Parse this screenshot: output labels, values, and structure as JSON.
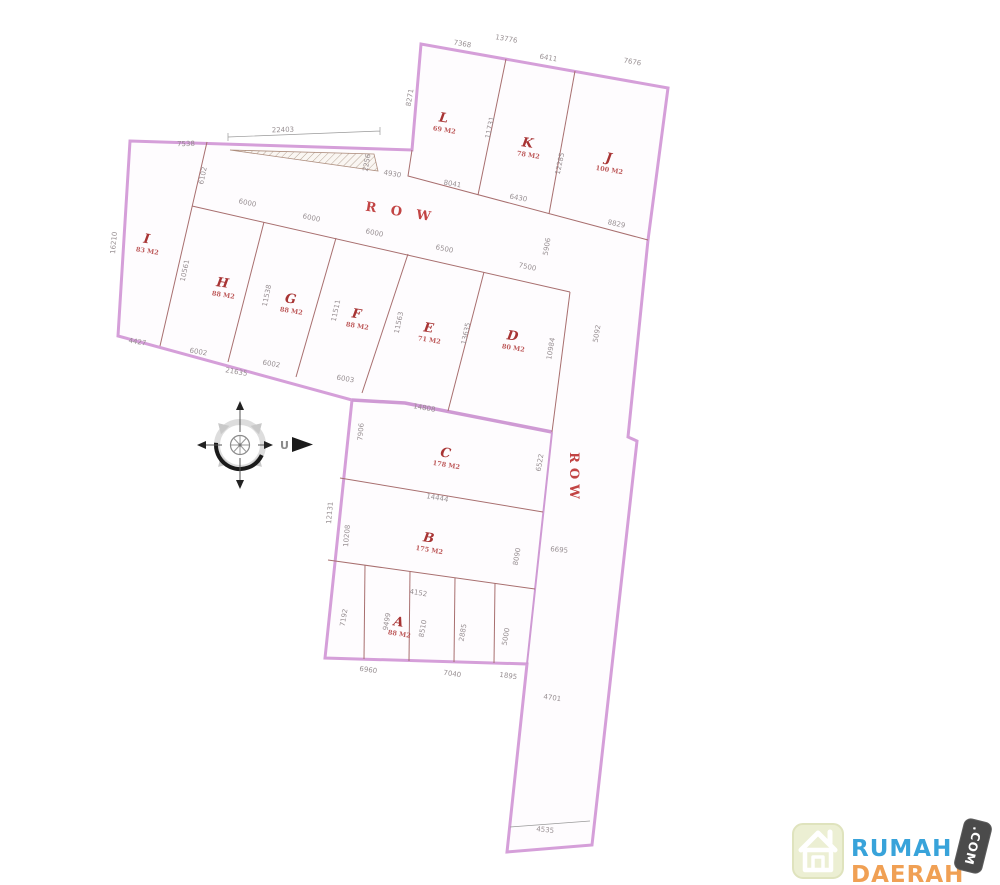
{
  "site_plan": {
    "road_label_diagonal": "R O W",
    "road_label_vertical": "ROW",
    "compass": {
      "north_label": "U"
    },
    "plots": [
      {
        "id": "L",
        "area": "69 M2",
        "x": 443,
        "y": 122,
        "r": 9
      },
      {
        "id": "K",
        "area": "78 M2",
        "x": 527,
        "y": 147,
        "r": 9
      },
      {
        "id": "J",
        "area": "100 M2",
        "x": 608,
        "y": 162,
        "r": 9
      },
      {
        "id": "I",
        "area": "83 M2",
        "x": 146,
        "y": 243,
        "r": 9
      },
      {
        "id": "H",
        "area": "88 M2",
        "x": 222,
        "y": 287,
        "r": 9
      },
      {
        "id": "G",
        "area": "88 M2",
        "x": 290,
        "y": 303,
        "r": 9
      },
      {
        "id": "F",
        "area": "88 M2",
        "x": 356,
        "y": 318,
        "r": 9
      },
      {
        "id": "E",
        "area": "71 M2",
        "x": 428,
        "y": 332,
        "r": 9
      },
      {
        "id": "D",
        "area": "80 M2",
        "x": 512,
        "y": 340,
        "r": 9
      },
      {
        "id": "C",
        "area": "178 M2",
        "x": 445,
        "y": 457,
        "r": 9
      },
      {
        "id": "B",
        "area": "175 M2",
        "x": 428,
        "y": 542,
        "r": 9
      },
      {
        "id": "A",
        "area": "88 M2",
        "x": 398,
        "y": 626,
        "r": 9
      }
    ],
    "dimensions": [
      {
        "v": "7368",
        "x": 462,
        "y": 46,
        "r": 10
      },
      {
        "v": "13776",
        "x": 506,
        "y": 41,
        "r": 10
      },
      {
        "v": "6411",
        "x": 548,
        "y": 60,
        "r": 10
      },
      {
        "v": "7676",
        "x": 632,
        "y": 64,
        "r": 10
      },
      {
        "v": "8271",
        "x": 412,
        "y": 98,
        "r": -80
      },
      {
        "v": "11731",
        "x": 492,
        "y": 128,
        "r": -78
      },
      {
        "v": "12285",
        "x": 562,
        "y": 164,
        "r": -78
      },
      {
        "v": "8041",
        "x": 452,
        "y": 186,
        "r": 10
      },
      {
        "v": "6430",
        "x": 518,
        "y": 200,
        "r": 10
      },
      {
        "v": "8829",
        "x": 616,
        "y": 226,
        "r": 12
      },
      {
        "v": "22403",
        "x": 283,
        "y": 132,
        "r": -2
      },
      {
        "v": "7538",
        "x": 186,
        "y": 146,
        "r": -1
      },
      {
        "v": "2256",
        "x": 369,
        "y": 163,
        "r": -80
      },
      {
        "v": "4930",
        "x": 392,
        "y": 176,
        "r": 10
      },
      {
        "v": "16210",
        "x": 116,
        "y": 243,
        "r": -85
      },
      {
        "v": "6102",
        "x": 205,
        "y": 176,
        "r": -78
      },
      {
        "v": "10561",
        "x": 187,
        "y": 271,
        "r": -78
      },
      {
        "v": "6000",
        "x": 247,
        "y": 205,
        "r": 12
      },
      {
        "v": "6000",
        "x": 311,
        "y": 220,
        "r": 12
      },
      {
        "v": "6000",
        "x": 374,
        "y": 235,
        "r": 12
      },
      {
        "v": "6500",
        "x": 444,
        "y": 251,
        "r": 12
      },
      {
        "v": "7500",
        "x": 527,
        "y": 269,
        "r": 12
      },
      {
        "v": "11538",
        "x": 269,
        "y": 296,
        "r": -78
      },
      {
        "v": "11511",
        "x": 338,
        "y": 311,
        "r": -78
      },
      {
        "v": "11563",
        "x": 401,
        "y": 323,
        "r": -78
      },
      {
        "v": "13635",
        "x": 468,
        "y": 334,
        "r": -78
      },
      {
        "v": "10984",
        "x": 553,
        "y": 349,
        "r": -80
      },
      {
        "v": "5906",
        "x": 549,
        "y": 247,
        "r": -80
      },
      {
        "v": "5092",
        "x": 599,
        "y": 334,
        "r": -80
      },
      {
        "v": "4427",
        "x": 137,
        "y": 344,
        "r": 10
      },
      {
        "v": "6002",
        "x": 198,
        "y": 354,
        "r": 10
      },
      {
        "v": "6002",
        "x": 271,
        "y": 366,
        "r": 10
      },
      {
        "v": "6003",
        "x": 345,
        "y": 381,
        "r": 10
      },
      {
        "v": "21635",
        "x": 236,
        "y": 374,
        "r": 10
      },
      {
        "v": "14808",
        "x": 424,
        "y": 410,
        "r": 10
      },
      {
        "v": "7906",
        "x": 363,
        "y": 432,
        "r": -85
      },
      {
        "v": "12131",
        "x": 332,
        "y": 513,
        "r": -85
      },
      {
        "v": "10208",
        "x": 349,
        "y": 536,
        "r": -85
      },
      {
        "v": "6522",
        "x": 542,
        "y": 463,
        "r": -80
      },
      {
        "v": "6695",
        "x": 559,
        "y": 552,
        "r": 5
      },
      {
        "v": "8090",
        "x": 519,
        "y": 557,
        "r": -80
      },
      {
        "v": "14444",
        "x": 437,
        "y": 500,
        "r": 10
      },
      {
        "v": "4152",
        "x": 418,
        "y": 595,
        "r": 9
      },
      {
        "v": "7192",
        "x": 346,
        "y": 618,
        "r": -80
      },
      {
        "v": "9499",
        "x": 389,
        "y": 622,
        "r": -80
      },
      {
        "v": "8510",
        "x": 425,
        "y": 629,
        "r": -80
      },
      {
        "v": "2885",
        "x": 465,
        "y": 633,
        "r": -80
      },
      {
        "v": "5000",
        "x": 508,
        "y": 637,
        "r": -80
      },
      {
        "v": "6960",
        "x": 368,
        "y": 672,
        "r": 8
      },
      {
        "v": "7040",
        "x": 452,
        "y": 676,
        "r": 8
      },
      {
        "v": "1895",
        "x": 508,
        "y": 678,
        "r": 8
      },
      {
        "v": "4701",
        "x": 552,
        "y": 700,
        "r": 8
      },
      {
        "v": "4535",
        "x": 545,
        "y": 832,
        "r": 6
      }
    ]
  },
  "branding": {
    "brand_top": "RUMAH",
    "brand_bottom": "DAERAH",
    "brand_tld": ".COM"
  }
}
